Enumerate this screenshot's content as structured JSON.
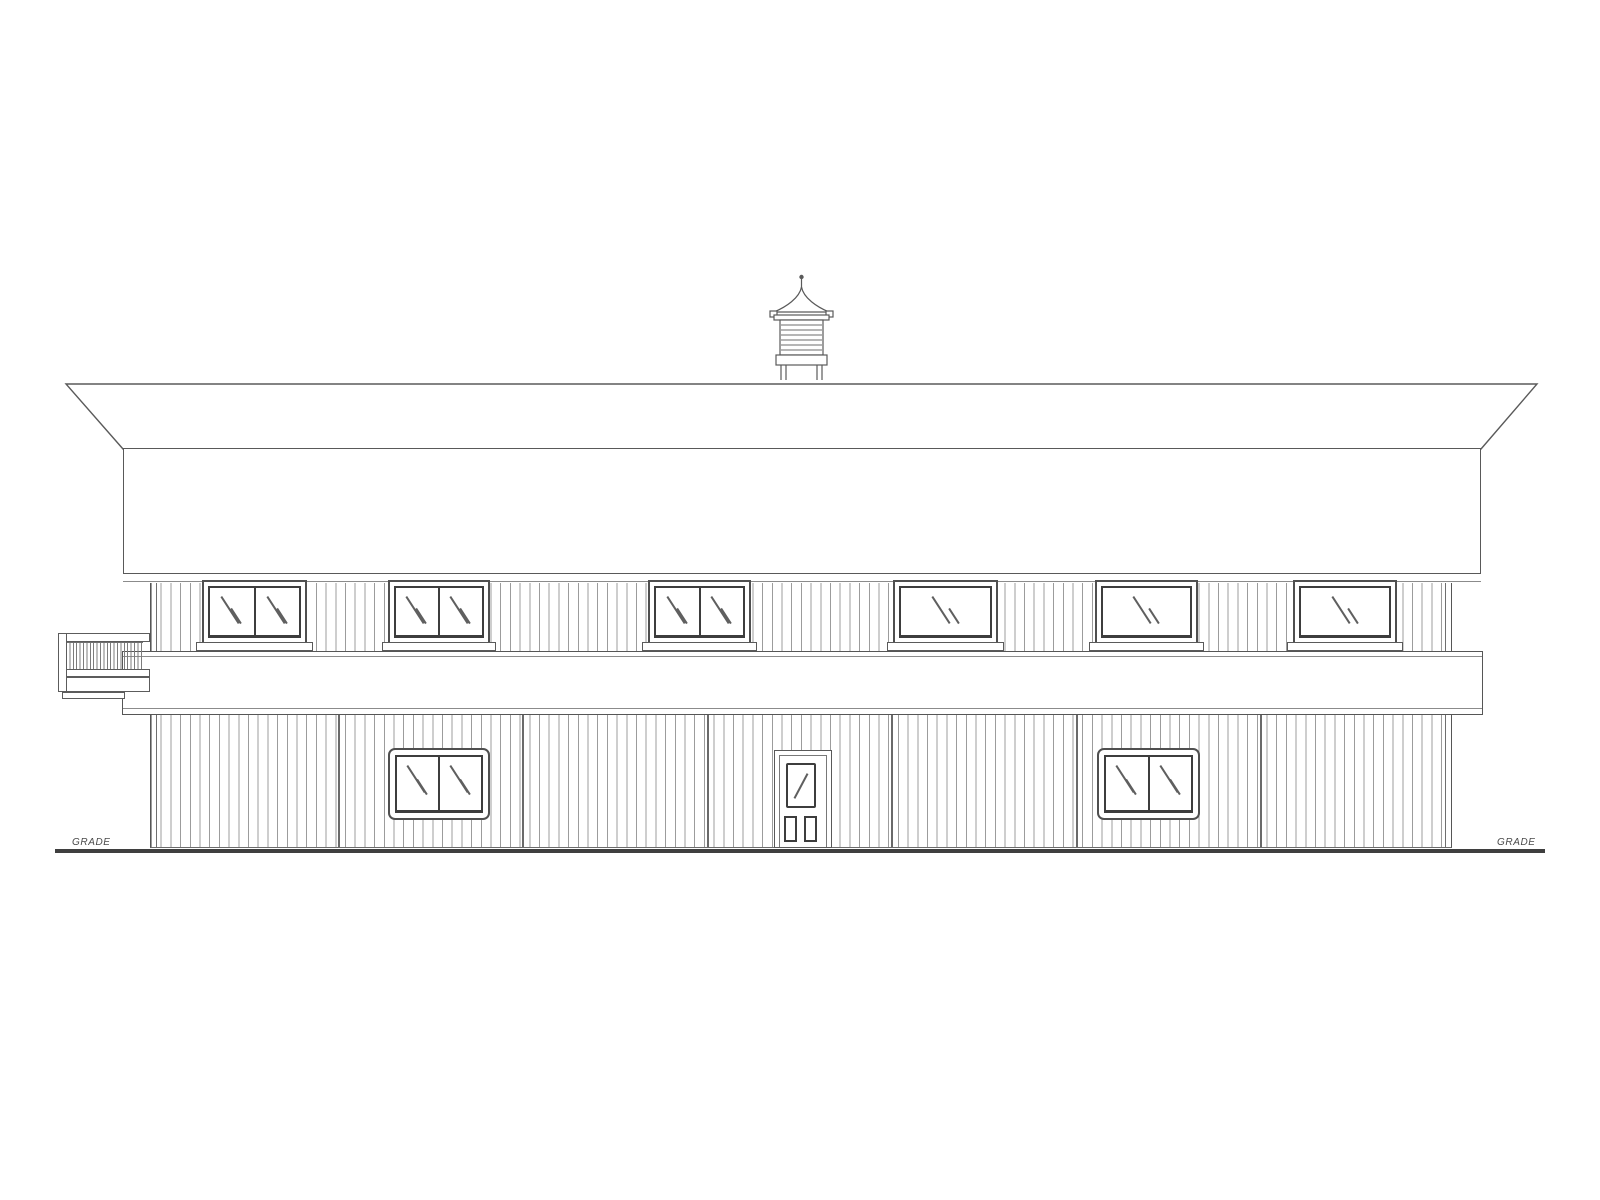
{
  "labels": {
    "grade_left": "GRADE",
    "grade_right": "GRADE"
  },
  "colors": {
    "background": "#ffffff",
    "outline": "#595959",
    "heavy_line": "#3f3f3f",
    "window_frame": "#4f4f4f",
    "glass_frame": "#3d3d3d",
    "siding_line": "#9c9c9c"
  },
  "elevation": {
    "upper_windows": [
      {
        "x": 202,
        "width": 105,
        "panes": 2
      },
      {
        "x": 388,
        "width": 102,
        "panes": 2
      },
      {
        "x": 648,
        "width": 103,
        "panes": 2
      },
      {
        "x": 893,
        "width": 105,
        "panes": 1
      },
      {
        "x": 1095,
        "width": 103,
        "panes": 1
      },
      {
        "x": 1293,
        "width": 104,
        "panes": 1
      }
    ],
    "lower_windows": [
      {
        "x": 388,
        "width": 102,
        "panes": 2
      },
      {
        "x": 1097,
        "width": 103,
        "panes": 2
      }
    ],
    "door": {
      "x": 774,
      "width": 58,
      "glass_panes": 1,
      "bottom_panels": 2
    },
    "panel_joints_x": [
      338,
      522,
      707,
      891,
      1076,
      1260
    ]
  }
}
